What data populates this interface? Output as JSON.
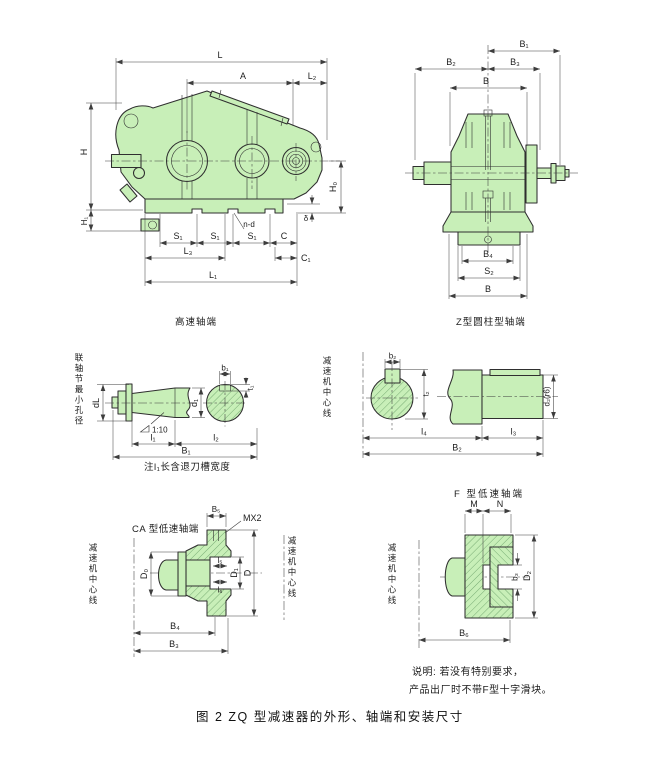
{
  "colors": {
    "paper": "#ffffff",
    "body_fill": "#c8efb8",
    "hatch": "#568f56",
    "line": "#2f2f2f",
    "dim": "#3d3d3d",
    "text": "#1c1c1c"
  },
  "figure_caption": "图 2  ZQ 型减速器的外形、轴端和安装尺寸",
  "notes": {
    "line1": "说明: 若没有特别要求，",
    "line2": "产品出厂时不带F型十字滑块。"
  },
  "main_view": {
    "caption": "高速轴端",
    "dims": {
      "L": "L",
      "A": "A",
      "L2": "L₂",
      "H": "H",
      "H1": "H₁",
      "H0": "H₀",
      "delta": "δ",
      "S1": "S₁",
      "nd": "n-d",
      "C": "C",
      "C1": "C₁",
      "L3": "L₃",
      "L1": "L₁"
    }
  },
  "end_view": {
    "caption": "Z型圆柱型轴端",
    "dims": {
      "B1": "B₁",
      "B2": "B₂",
      "B3": "B₃",
      "B_top": "B",
      "B4": "B₄",
      "S2": "S₂",
      "B_bottom": "B"
    }
  },
  "taper_view": {
    "axis_label": "联轴节最小孔径",
    "note": "注l₁长含退刀槽宽度",
    "dims": {
      "dL": "dL",
      "d1": "d₁",
      "b1": "b₁",
      "t1": "t₁",
      "taper": "1:10",
      "l1": "l₁",
      "l2": "l₂",
      "B1": "B₁"
    }
  },
  "low_speed_view": {
    "axis_label": "减速机中心线",
    "dims": {
      "b2": "b₂",
      "t2": "t₂",
      "d2": "d₂(r6)",
      "l4": "l₄",
      "l3": "l₃",
      "B2": "B₂"
    }
  },
  "ca_view": {
    "caption": "CA 型低速轴端",
    "axis_label": "减速机中心线",
    "dims": {
      "B5": "B₅",
      "MX2": "MX2",
      "D0": "D₀",
      "l5": "l₅",
      "l6": "l₆",
      "D1": "D₁",
      "D": "D",
      "B4": "B₄",
      "B3": "B₃"
    }
  },
  "f_view": {
    "caption": "F 型低速轴端",
    "axis_label": "减速机中心线",
    "dims": {
      "M": "M",
      "N": "N",
      "b3": "b₃",
      "D2": "D₂",
      "B6": "B₆"
    }
  }
}
